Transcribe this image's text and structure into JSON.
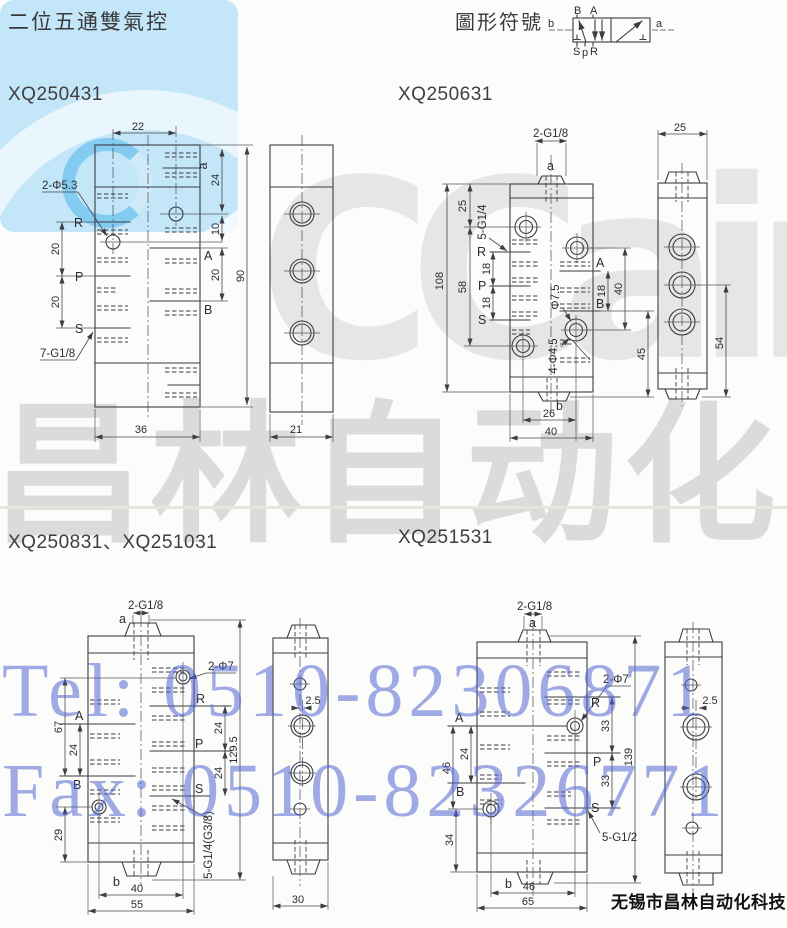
{
  "page": {
    "title": "二位五通雙氣控",
    "symbol_title": "圖形符號",
    "footer": "无锡市昌林自动化科技",
    "models": {
      "m1": "XQ250431",
      "m2": "XQ250631",
      "m3": "XQ250831、XQ251031",
      "m4": "XQ251531"
    }
  },
  "watermark": {
    "cc": "CCair",
    "cn": "昌林自动化",
    "tel": "Tel: 0510-82306871",
    "fax": "Fax: 0510-82326771",
    "blue": "#c3e6f8",
    "gray_text": "#bdbdbf",
    "blue_text": "#5266d4"
  },
  "symbol": {
    "b": "b",
    "a": "a",
    "B": "B",
    "A": "A",
    "S": "S",
    "p": "p",
    "R": "R"
  },
  "d1": {
    "dim22": "22",
    "dim24": "24",
    "dim10": "10",
    "dim20r": "20",
    "dim90": "90",
    "dim20l1": "20",
    "dim20l2": "20",
    "dim36": "36",
    "dim21": "21",
    "a": "a",
    "A": "A",
    "B": "B",
    "R": "R",
    "P": "P",
    "S": "S",
    "holes": "2-Φ5.3",
    "thread": "7-G1/8"
  },
  "d2": {
    "top_thread": "2-G1/8",
    "a": "a",
    "b": "b",
    "dim108": "108",
    "dim25": "25",
    "dim58": "58",
    "thread5": "5-G1/4",
    "R": "R",
    "P": "P",
    "S": "S",
    "dim18l1": "18",
    "dim18l2": "18",
    "A": "A",
    "B": "B",
    "dim18r": "18",
    "dim40r": "40",
    "dim45": "45",
    "phi75": "Φ7.5",
    "phi45": "4-Φ4.5",
    "dim26": "26",
    "dim40b": "40",
    "dim25s": "25",
    "dim54": "54"
  },
  "d3": {
    "top_thread": "2-G1/8",
    "a": "a",
    "b": "b",
    "holes": "2-Φ7",
    "R": "R",
    "P": "P",
    "S": "S",
    "A": "A",
    "B": "B",
    "dim67": "67",
    "dim24l": "24",
    "dim29": "29",
    "dim24r1": "24",
    "dim24r2": "24",
    "dim1295": "129.5",
    "thread5": "5-G1/4(G3/8)",
    "dim40": "40",
    "dim55": "55",
    "dim25s": "2.5",
    "dim30": "30"
  },
  "d4": {
    "top_thread": "2-G1/8",
    "a": "a",
    "b": "b",
    "holes": "2-Φ7",
    "R": "R",
    "P": "P",
    "S": "S",
    "A": "A",
    "B": "B",
    "dim24": "24",
    "dim46l": "46",
    "dim34": "34",
    "dim33a": "33",
    "dim33b": "33",
    "dim139": "139",
    "thread5": "5-G1/2",
    "dim46b": "46",
    "dim65": "65",
    "dim25s": "2.5"
  }
}
